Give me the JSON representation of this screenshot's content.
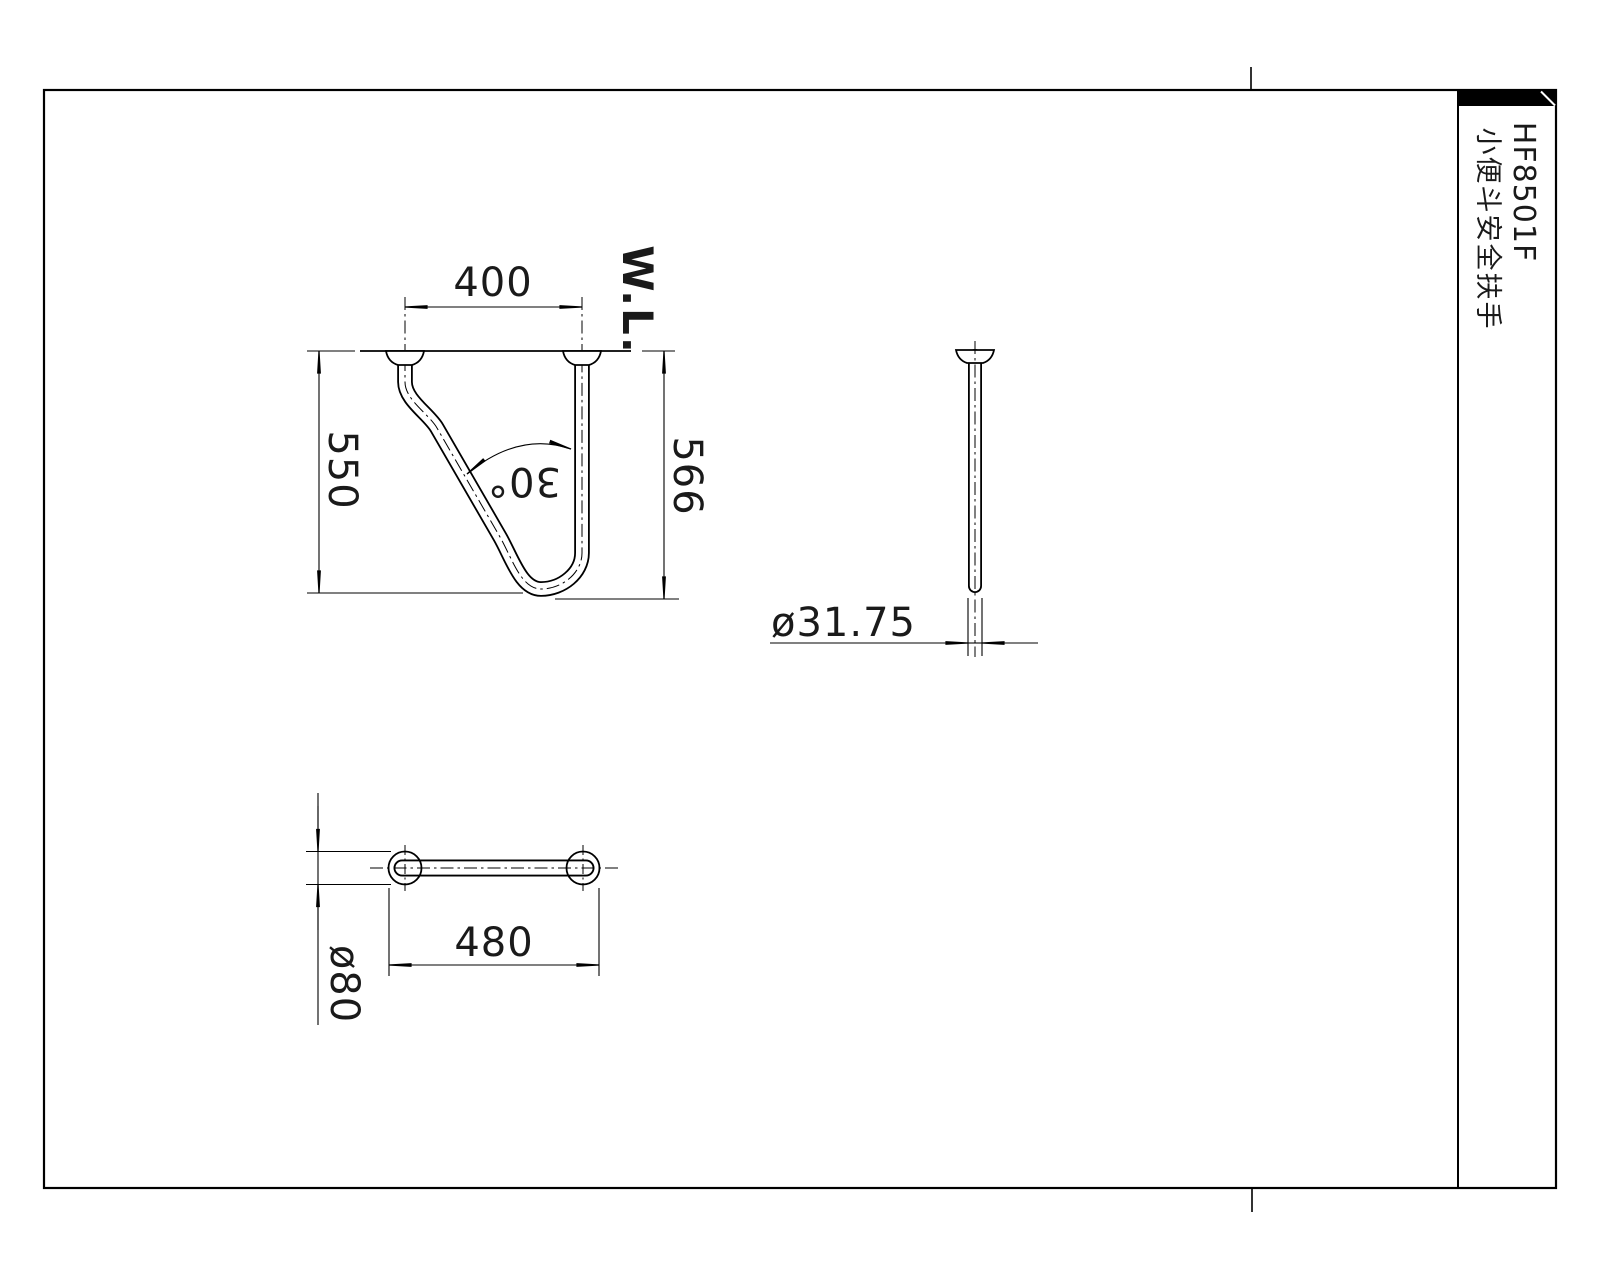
{
  "drawing": {
    "title_block": {
      "model_code": "HF8501F",
      "product_name": "小便斗安全扶手"
    },
    "front_view": {
      "mount_center_distance": "400",
      "height_left": "550",
      "height_right": "566",
      "bend_angle": "30°",
      "wall_line_label": "W.L."
    },
    "side_view": {
      "tube_diameter": "ø31.75"
    },
    "bottom_view": {
      "flange_outer_span": "480",
      "flange_diameter": "ø80"
    },
    "colors": {
      "line": "#000000",
      "background": "#ffffff",
      "title_bar": "#000000"
    }
  }
}
